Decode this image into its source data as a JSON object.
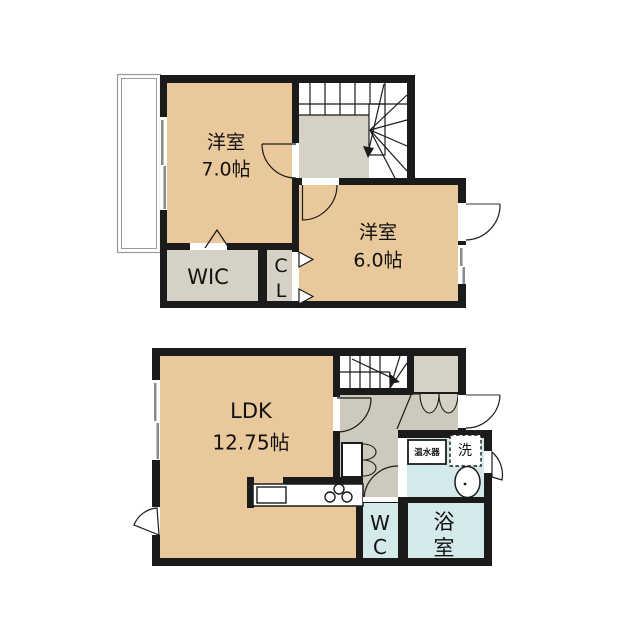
{
  "colors": {
    "wall": "#1b1b1b",
    "tatami_room": "#e9c99b",
    "closet": "#d5d1c5",
    "hallway": "#cdc9bc",
    "bathroom": "#d4e9ea",
    "balcony_line": "#999999",
    "window_line": "#8a8a8a"
  },
  "floor2": {
    "bedroom1": {
      "label": "洋室",
      "size": "7.0帖"
    },
    "bedroom2": {
      "label": "洋室",
      "size": "6.0帖"
    },
    "wic": "WIC",
    "closet": "CL"
  },
  "floor1": {
    "ldk": {
      "label": "LDK",
      "size": "12.75帖"
    },
    "toilet": "WC",
    "bathroom": "浴室",
    "water_heater": "温水器",
    "washer": "洗"
  }
}
